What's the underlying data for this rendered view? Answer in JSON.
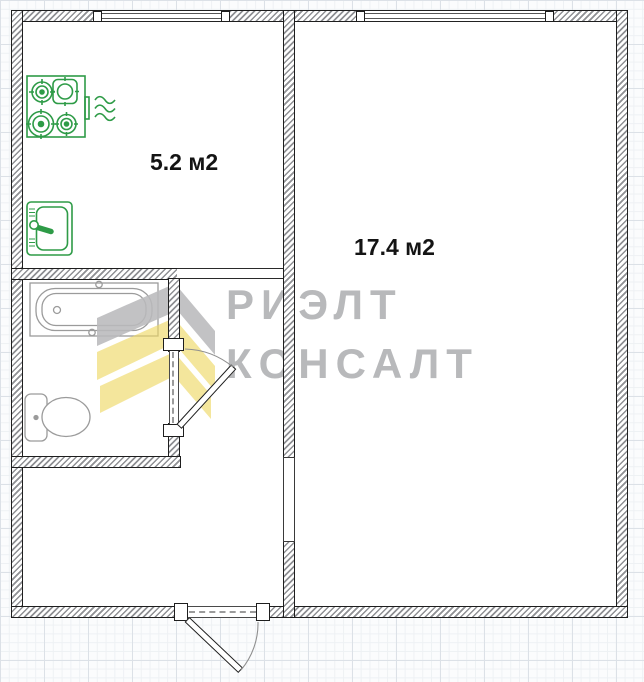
{
  "plan": {
    "title": "apartment-floor-plan",
    "rooms": [
      {
        "name": "kitchen",
        "area_label": "5.2 м2"
      },
      {
        "name": "living-room",
        "area_label": "17.4 м2"
      },
      {
        "name": "bathroom",
        "area_label": ""
      },
      {
        "name": "hallway",
        "area_label": ""
      }
    ],
    "fixtures": [
      "stove-icon",
      "vent-waves-icon",
      "sink-icon",
      "bathtub-icon",
      "toilet-icon"
    ],
    "features": [
      "window",
      "window",
      "bathroom-door",
      "entrance-door",
      "doorway-opening",
      "kitchen-opening"
    ]
  },
  "watermark": {
    "line1": "РИЭЛТ",
    "line2": "КОНСАЛТ",
    "logo": "chevron-diamond-logo"
  },
  "colors": {
    "fixture_green": "#2e9b47",
    "fixture_gray": "#9b9b9b",
    "watermark_gray": "#b5b6b8",
    "watermark_yellow": "#edd75f",
    "wall_edge": "#1e1e1e",
    "grid_line": "#dce1e7"
  }
}
